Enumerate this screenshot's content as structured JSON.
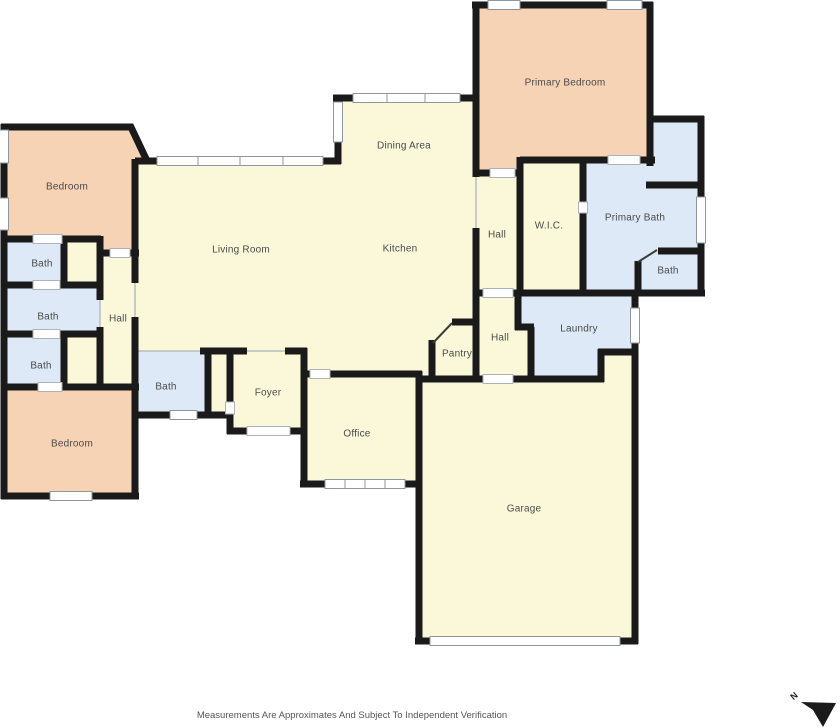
{
  "plan": {
    "rooms": [
      {
        "id": "bedroom-1",
        "label": "Bedroom",
        "x": 67,
        "y": 186
      },
      {
        "id": "bath-1",
        "label": "Bath",
        "x": 42,
        "y": 263
      },
      {
        "id": "bath-2",
        "label": "Bath",
        "x": 48,
        "y": 316
      },
      {
        "id": "bath-3",
        "label": "Bath",
        "x": 41,
        "y": 365
      },
      {
        "id": "bedroom-2",
        "label": "Bedroom",
        "x": 72,
        "y": 443
      },
      {
        "id": "hall-west",
        "label": "Hall",
        "x": 118,
        "y": 318
      },
      {
        "id": "living-room",
        "label": "Living Room",
        "x": 241,
        "y": 249
      },
      {
        "id": "dining-area",
        "label": "Dining Area",
        "x": 404,
        "y": 145
      },
      {
        "id": "kitchen",
        "label": "Kitchen",
        "x": 400,
        "y": 248
      },
      {
        "id": "bath-center",
        "label": "Bath",
        "x": 166,
        "y": 386
      },
      {
        "id": "foyer",
        "label": "Foyer",
        "x": 268,
        "y": 392
      },
      {
        "id": "office",
        "label": "Office",
        "x": 357,
        "y": 433
      },
      {
        "id": "hall-center",
        "label": "Hall",
        "x": 497,
        "y": 234
      },
      {
        "id": "wic",
        "label": "W.I.C.",
        "x": 549,
        "y": 225
      },
      {
        "id": "primary-bath",
        "label": "Primary Bath",
        "x": 635,
        "y": 217
      },
      {
        "id": "bath-primary-wc",
        "label": "Bath",
        "x": 668,
        "y": 270
      },
      {
        "id": "hall-south",
        "label": "Hall",
        "x": 500,
        "y": 337
      },
      {
        "id": "pantry",
        "label": "Pantry",
        "x": 457,
        "y": 353
      },
      {
        "id": "laundry",
        "label": "Laundry",
        "x": 579,
        "y": 328
      },
      {
        "id": "primary-bedroom",
        "label": "Primary Bedroom",
        "x": 565,
        "y": 82
      },
      {
        "id": "garage",
        "label": "Garage",
        "x": 524,
        "y": 508
      }
    ]
  },
  "compass": {
    "label": "N"
  },
  "footer": {
    "disclaimer": "Measurements Are Approximates And Subject To Independent Verification"
  },
  "colors": {
    "background": "#ffffff",
    "wall": "#1a1a1a",
    "room_default": "#faf8d9",
    "room_bedroom": "#f7d3b5",
    "room_bath": "#dde9f6",
    "label_text": "#4a4a4a",
    "window_outline": "#8f969c"
  }
}
